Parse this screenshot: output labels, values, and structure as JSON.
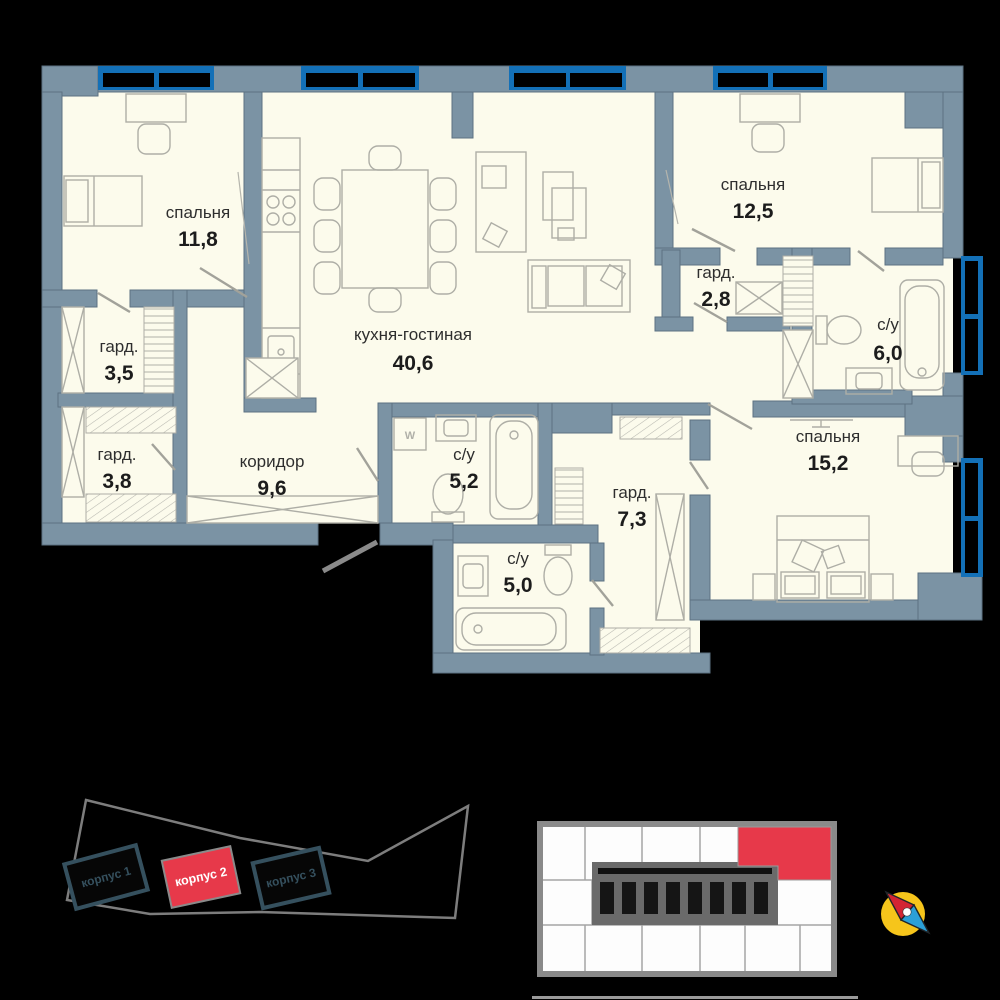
{
  "plan": {
    "rooms": [
      {
        "id": "bedroom-1",
        "name": "спальня",
        "area": "11,8"
      },
      {
        "id": "kitchen-living",
        "name": "кухня-гостиная",
        "area": "40,6"
      },
      {
        "id": "bedroom-2",
        "name": "спальня",
        "area": "12,5"
      },
      {
        "id": "wardrobe-1",
        "name": "гард.",
        "area": "2,8"
      },
      {
        "id": "bathroom-1",
        "name": "с/у",
        "area": "6,0"
      },
      {
        "id": "wardrobe-2",
        "name": "гард.",
        "area": "3,5"
      },
      {
        "id": "wardrobe-3",
        "name": "гард.",
        "area": "3,8"
      },
      {
        "id": "corridor",
        "name": "коридор",
        "area": "9,6"
      },
      {
        "id": "bathroom-2",
        "name": "с/у",
        "area": "5,2"
      },
      {
        "id": "wardrobe-4",
        "name": "гард.",
        "area": "7,3"
      },
      {
        "id": "bathroom-3",
        "name": "с/у",
        "area": "5,0"
      },
      {
        "id": "bedroom-3",
        "name": "спальня",
        "area": "15,2"
      }
    ],
    "washer_label": "W"
  },
  "site_plan": {
    "buildings": [
      {
        "label": "корпус 1",
        "highlighted": false
      },
      {
        "label": "корпус 2",
        "highlighted": true
      },
      {
        "label": "корпус 3",
        "highlighted": false
      }
    ]
  },
  "minimap": {
    "highlighted_unit_color": "#e7394a"
  },
  "colors": {
    "background": "#000000",
    "wall": "#7b93a4",
    "room_fill": "#fcfbec",
    "window_blue": "#1370b7",
    "highlight_red": "#e7394a",
    "compass_yellow": "#f6c51b",
    "compass_red": "#d32433",
    "compass_blue": "#2ba0d8"
  }
}
